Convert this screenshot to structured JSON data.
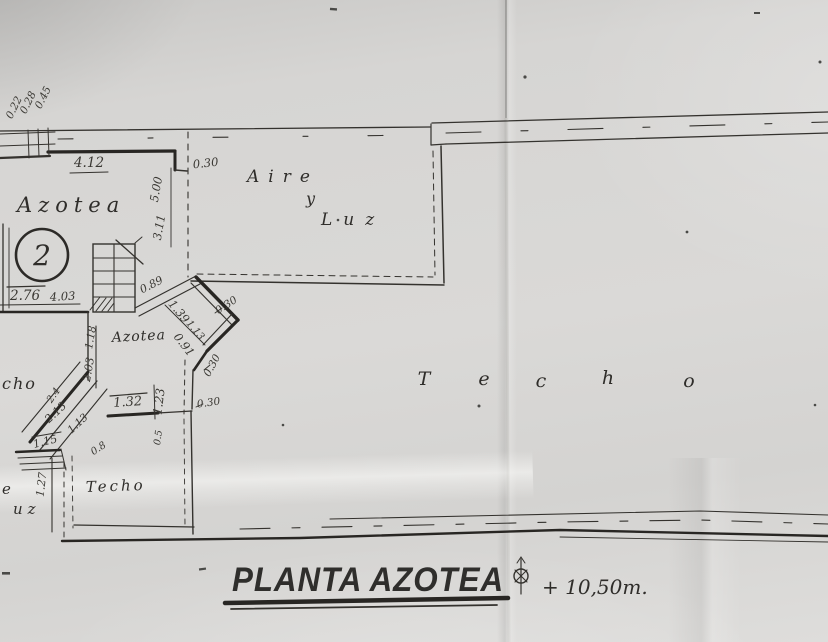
{
  "title_block": {
    "drawing_title": "PLANTA AZOTEA",
    "elevation_note": "+ 10,50m."
  },
  "labels": {
    "azotea_main": "Azotea",
    "stair_number": "2",
    "azotea_small": "Azotea",
    "aire": "Aire",
    "conj_y": "y",
    "luz": "Luz",
    "techo_spread": [
      "T",
      "e",
      "c",
      "h",
      "o"
    ],
    "techo_small": "Techo",
    "partial_techo": "cho",
    "partial_aire": "e",
    "partial_luz": "uz"
  },
  "dimensions": {
    "wall_022": "0.22",
    "wall_028": "0.28",
    "wall_045": "0.45",
    "top_412": "4.12",
    "court_030": "0.30",
    "side_500": "5.00",
    "side_311": "3.11",
    "row_276": "2.76",
    "row_403": "4.03",
    "diag_089": "0.89",
    "diag_139": "1.39",
    "diag_113a": "1.13",
    "diag_091": "0.91",
    "zig_030_a": "0.30",
    "zig_030_b": "0.30",
    "zig_030_c": "0.30",
    "wall_118": "1.18",
    "wall_203": "2.03",
    "col_123": "1.23",
    "row_132": "1.32",
    "diag_213": "2.13",
    "diag_113b": "1.13",
    "diag_115": "1.15",
    "diag_24": "2.4",
    "col_127": "1.27",
    "diag_08": "0.8",
    "col_05": "0.5"
  },
  "colors": {
    "paper": "#d6d5d3",
    "ink": "#34322e",
    "stamp": "#1d1c1a"
  }
}
